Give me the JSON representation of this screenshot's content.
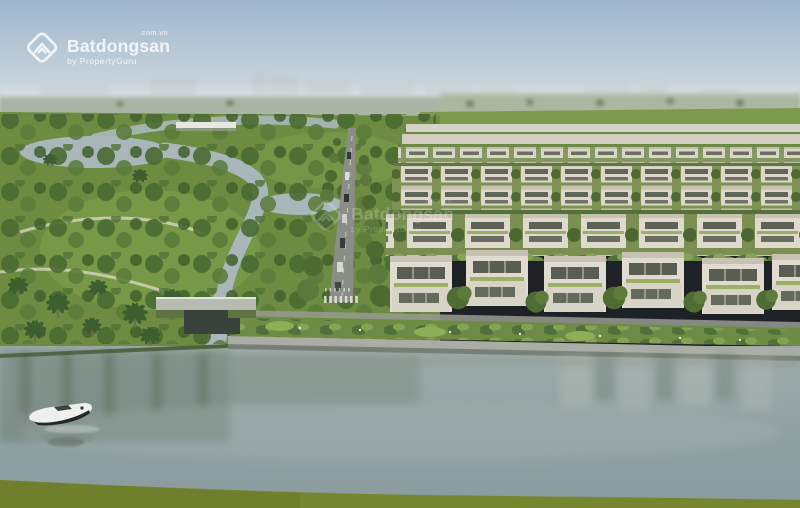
{
  "watermark": {
    "brand": "Batdongsan",
    "suffix": ".com.vn",
    "tagline": "by PropertyGuru",
    "color": "#ffffff"
  },
  "icons": {
    "logo": "batdongsan-diamond-chevron-icon"
  },
  "colors": {
    "sky_top": "#9fb6cd",
    "sky_horizon": "#e0e2dd",
    "park_green": "#6d8c41",
    "lagoon_water": "#a9b7ba",
    "villa_wall": "#dfdacd",
    "river_water": "#93a3a3",
    "foreground_grass": "#76862f",
    "road": "#8b8e86"
  }
}
